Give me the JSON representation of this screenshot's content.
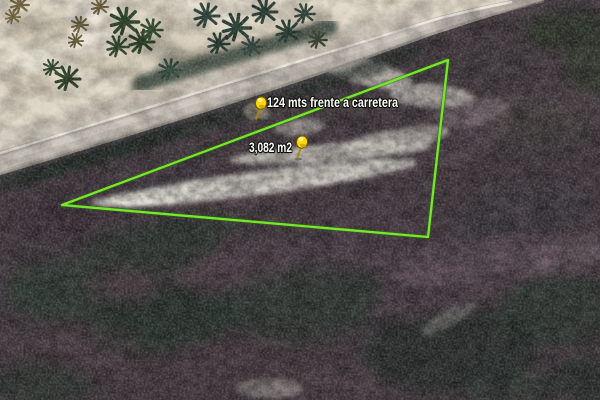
{
  "view": {
    "type": "satellite-imagery",
    "width": 600,
    "height": 400
  },
  "parcel": {
    "outline_color": "#78e62c",
    "vertices": [
      [
        448,
        60
      ],
      [
        62,
        205
      ],
      [
        428,
        237
      ]
    ],
    "label_text_color": "#ffffff",
    "pushpin_color": "#ffdb00",
    "placemarks": [
      {
        "icon": "yellow-pushpin-icon",
        "label": "124 mts frente a carretera",
        "tip_x": 256,
        "tip_y": 119,
        "label_x": 267,
        "label_y": 107,
        "label_width": 131
      },
      {
        "icon": "yellow-pushpin-icon",
        "label": "3,082 m2",
        "tip_x": 297,
        "tip_y": 158,
        "label_x": 249,
        "label_y": 152,
        "label_width": 43
      }
    ]
  }
}
